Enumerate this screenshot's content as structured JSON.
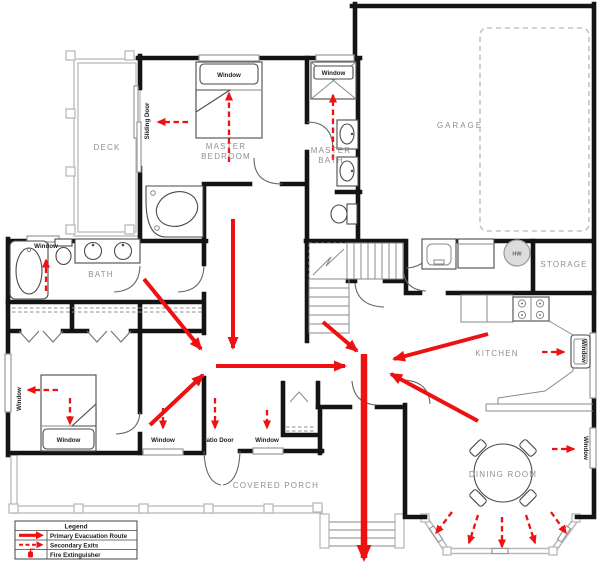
{
  "rooms": {
    "deck": "DECK",
    "master_bedroom_line1": "MASTER",
    "master_bedroom_line2": "BEDROOM",
    "master_bath_line1": "MASTER",
    "master_bath_line2": "BATH",
    "garage": "GARAGE",
    "bath": "BATH",
    "storage": "STORAGE",
    "kitchen": "KITCHEN",
    "dining_room": "DINING ROOM",
    "covered_porch": "COVERED PORCH"
  },
  "labels": {
    "window": "Window",
    "sliding_door": "Sliding Door",
    "patio_door": "Patio Door",
    "water_heater": "HW"
  },
  "legend": {
    "title": "Legend",
    "items": [
      {
        "icon": "primary-route-arrow-icon",
        "label": "Primary Evacuation Route"
      },
      {
        "icon": "secondary-exit-arrow-icon",
        "label": "Secondary Exits"
      },
      {
        "icon": "fire-extinguisher-icon",
        "label": "Fire Extinguisher"
      }
    ]
  },
  "colors": {
    "route_red": "#ee1111",
    "wall_black": "#141414",
    "room_label_gray": "#8f8f8f",
    "porch_gray": "#b9b9b9"
  }
}
